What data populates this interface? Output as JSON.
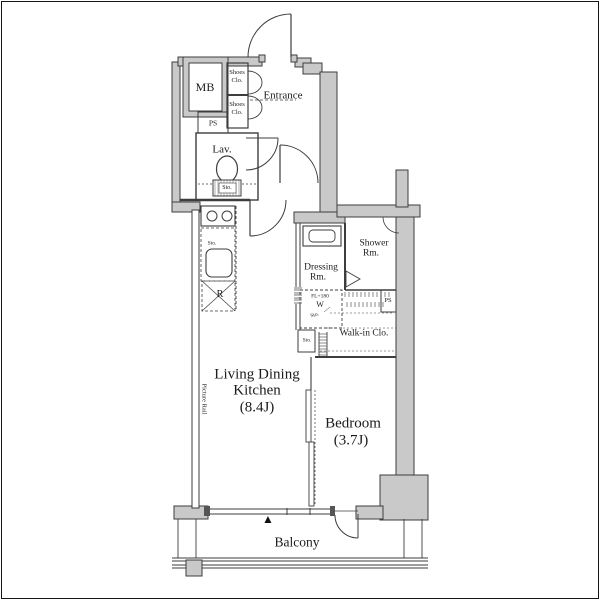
{
  "floorplan": {
    "unit": {
      "living": [
        "Living Dining",
        "Kitchen",
        "(8.4J)"
      ],
      "bedroom": [
        "Bedroom",
        "(3.7J)"
      ],
      "balcony": "Balcony",
      "entrance": "Entrance",
      "lavatory": "Lav.",
      "meter_box": "MB",
      "pipe_space_upper": "PS",
      "pipe_space_lower": "PS",
      "shoes_closet_upper": [
        "Shoes",
        "Clo."
      ],
      "shoes_closet_lower": [
        "Shoes",
        "Clo."
      ],
      "dressing_room": [
        "Dressing",
        "Rm."
      ],
      "shower_room": [
        "Shower",
        "Rm."
      ],
      "walk_in_closet": "Walk-in Clo.",
      "laundry": [
        "FL+180",
        "W",
        "Sto."
      ],
      "storage_hall": "Sto.",
      "storage_toilet": "Sto.",
      "storage_kitchen": "Sto.",
      "refrigerator": "R",
      "picture_rail": "Picture Rail",
      "direction_marker": "▲"
    },
    "colors": {
      "background": "#ffffff",
      "wall_fill": "#c9c9c9",
      "line": "#3d3d3d",
      "text": "#1b1b1b"
    }
  }
}
